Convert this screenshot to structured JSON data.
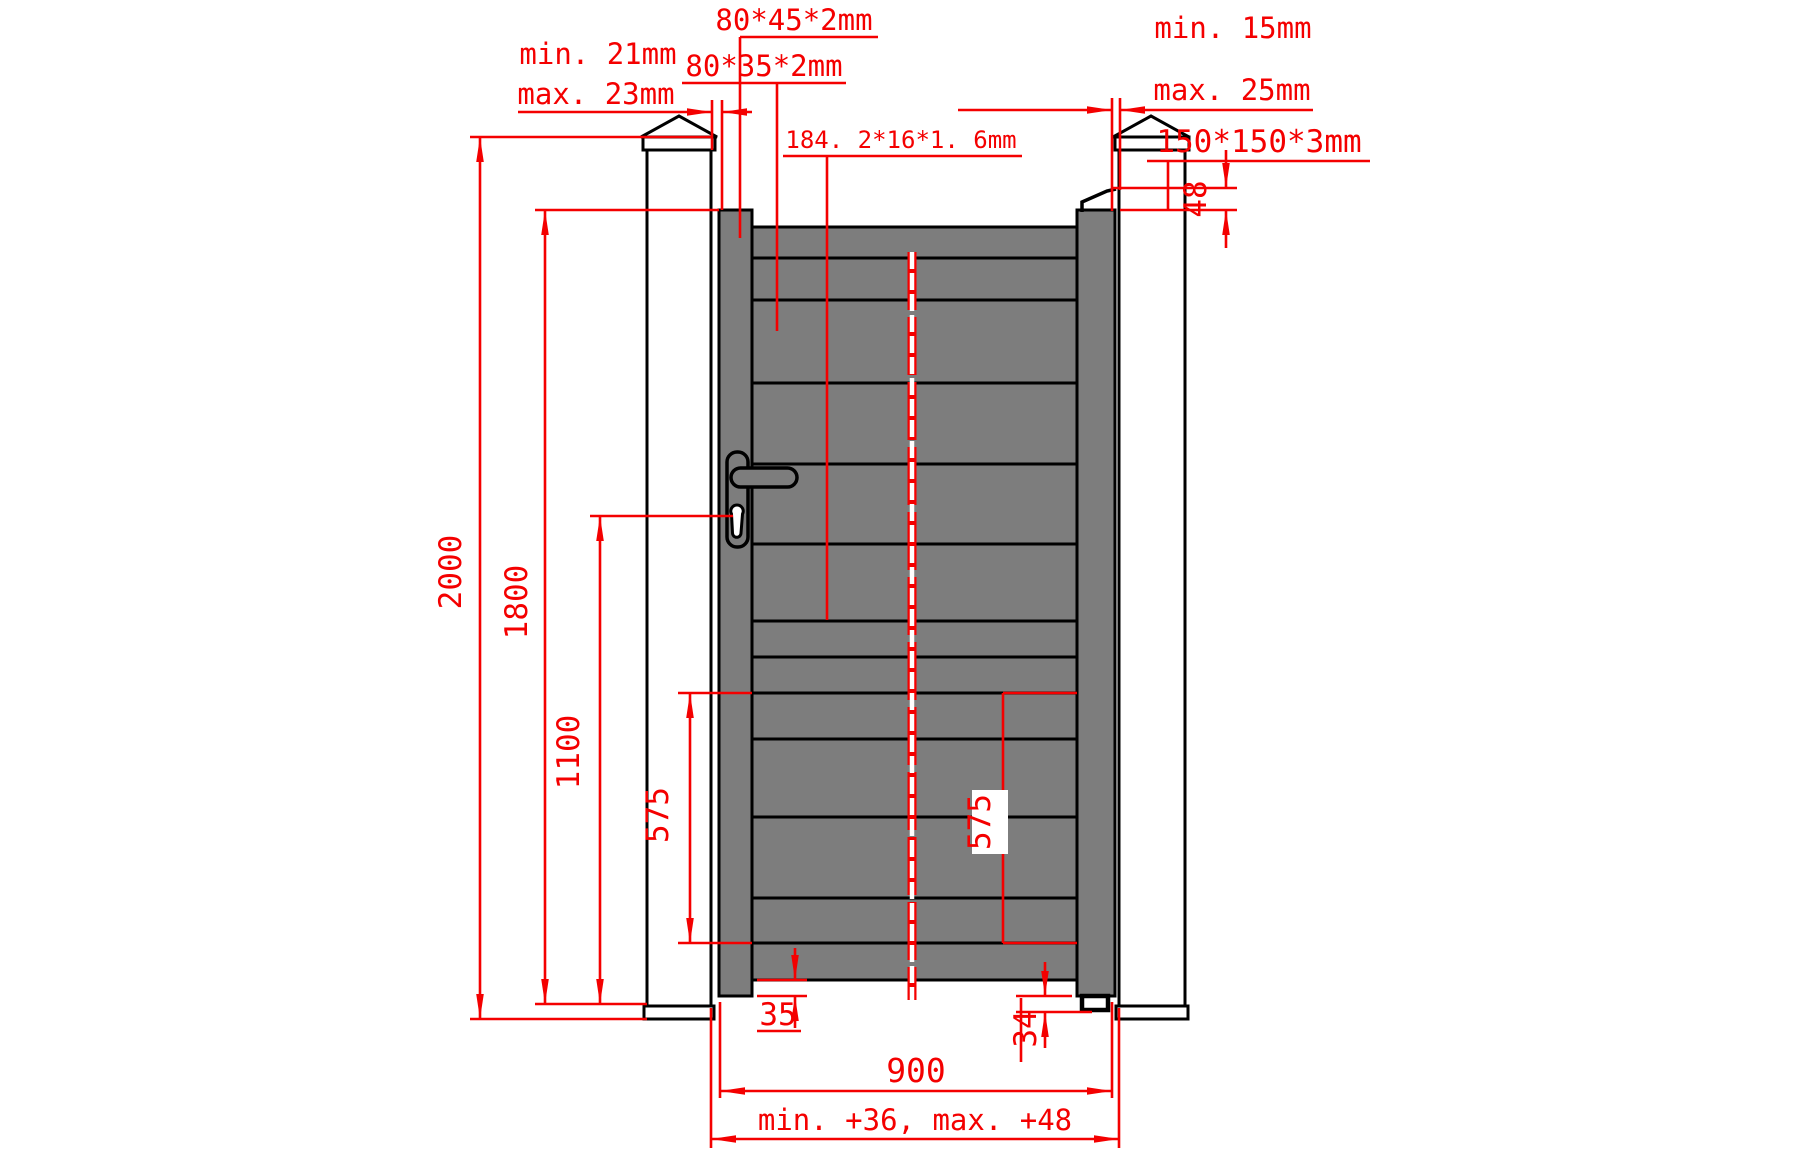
{
  "drawing": {
    "subject": "Technical elevation drawing of a single pedestrian swing gate between two square posts",
    "colors": {
      "dimension_red": "#f40000",
      "outline_black": "#000000",
      "panel_gray": "#7d7d7d",
      "background": "#ffffff"
    },
    "hinge_side_gap": {
      "min": "min. 21mm",
      "max": "max. 23mm"
    },
    "latch_side_gap": {
      "min": "min. 15mm",
      "max": "max. 25mm"
    },
    "profiles": {
      "stile": "80*45*2mm",
      "rail": "80*35*2mm",
      "plank": "184. 2*16*1. 6mm",
      "post": "150*150*3mm"
    },
    "dims": {
      "total_height": "2000",
      "gate_height": "1800",
      "handle_height": "1100",
      "segment_left": "575",
      "segment_right": "575",
      "hinge_drop": "48",
      "bottom_clearance_left": "35",
      "bottom_clearance_right": "34",
      "gate_width": "900",
      "opening_width": "min. +36, max. +48"
    }
  }
}
